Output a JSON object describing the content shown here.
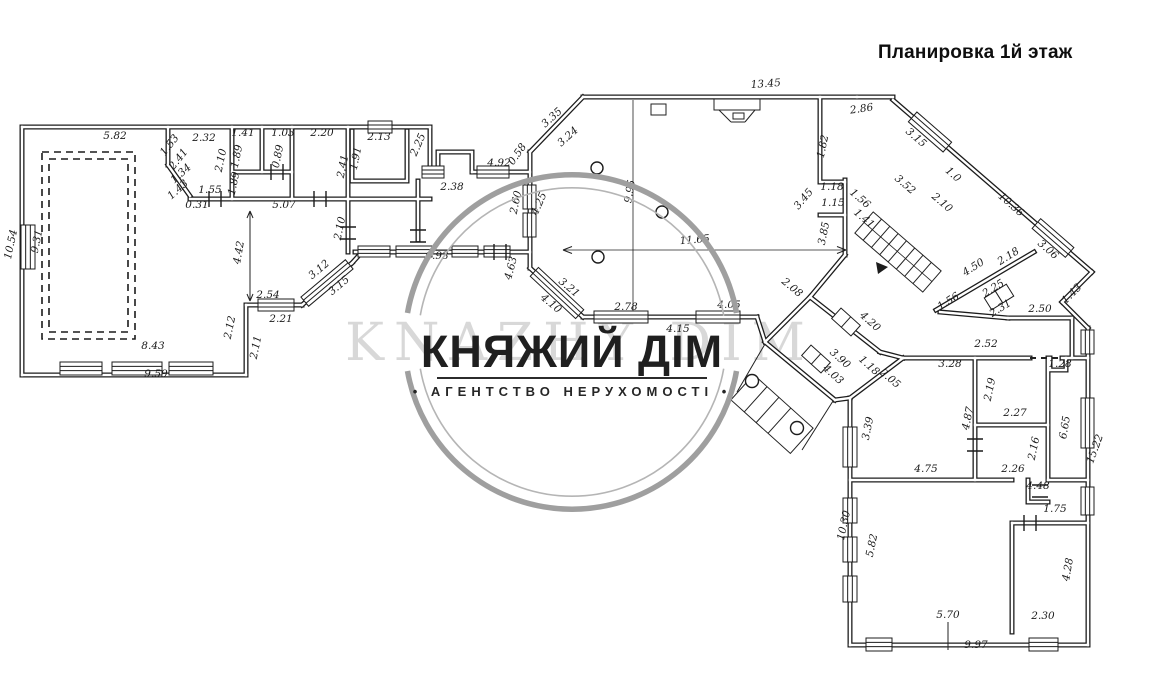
{
  "title": "Планировка 1й этаж",
  "watermark": {
    "brand": "КНЯЖИЙ ДІМ",
    "tagline": "• АГЕНТСТВО НЕРУХОМОСТІ •",
    "ghost": "KNAZHY DIM",
    "ring_color": "#9f9f9f",
    "text_color": "#1f1f1f"
  },
  "plan": {
    "ink_color": "#1c1c1c",
    "dimensions": [
      {
        "t": "5.82",
        "x": 115,
        "y": 139,
        "r": 0
      },
      {
        "t": "2.32",
        "x": 204,
        "y": 141,
        "r": 0
      },
      {
        "t": "1.53",
        "x": 172,
        "y": 147,
        "r": -52
      },
      {
        "t": "2.41",
        "x": 181,
        "y": 161,
        "r": -52
      },
      {
        "t": "2.10",
        "x": 224,
        "y": 161,
        "r": -78
      },
      {
        "t": "1.41",
        "x": 243,
        "y": 136,
        "r": 0
      },
      {
        "t": "1.89",
        "x": 240,
        "y": 157,
        "r": -78
      },
      {
        "t": "1.03",
        "x": 283,
        "y": 136,
        "r": 0
      },
      {
        "t": "0.89",
        "x": 281,
        "y": 157,
        "r": -78
      },
      {
        "t": "2.20",
        "x": 322,
        "y": 136,
        "r": 0
      },
      {
        "t": "1.89",
        "x": 237,
        "y": 184,
        "r": -78
      },
      {
        "t": "1.55",
        "x": 210,
        "y": 193,
        "r": 0
      },
      {
        "t": "1.34",
        "x": 183,
        "y": 176,
        "r": -42
      },
      {
        "t": "1.43",
        "x": 180,
        "y": 192,
        "r": -42
      },
      {
        "t": "0.31",
        "x": 197,
        "y": 208,
        "r": 0
      },
      {
        "t": "5.07",
        "x": 284,
        "y": 208,
        "r": 0
      },
      {
        "t": "2.13",
        "x": 379,
        "y": 140,
        "r": 0
      },
      {
        "t": "1.91",
        "x": 359,
        "y": 159,
        "r": -78
      },
      {
        "t": "2.41",
        "x": 346,
        "y": 167,
        "r": -78
      },
      {
        "t": "2.25",
        "x": 421,
        "y": 146,
        "r": -66
      },
      {
        "t": "2.10",
        "x": 343,
        "y": 229,
        "r": -78
      },
      {
        "t": "2.38",
        "x": 452,
        "y": 190,
        "r": 0
      },
      {
        "t": "4.92",
        "x": 499,
        "y": 166,
        "r": 0
      },
      {
        "t": "0.58",
        "x": 520,
        "y": 156,
        "r": -55
      },
      {
        "t": "2.60",
        "x": 519,
        "y": 203,
        "r": -78
      },
      {
        "t": "4.25",
        "x": 542,
        "y": 205,
        "r": -66
      },
      {
        "t": "13.45",
        "x": 766,
        "y": 87,
        "r": -4
      },
      {
        "t": "3.35",
        "x": 554,
        "y": 120,
        "r": -42
      },
      {
        "t": "3.24",
        "x": 570,
        "y": 139,
        "r": -42
      },
      {
        "t": "9.95",
        "x": 633,
        "y": 192,
        "r": -80
      },
      {
        "t": "11.65",
        "x": 695,
        "y": 243,
        "r": -5
      },
      {
        "t": "2.86",
        "x": 862,
        "y": 112,
        "r": -8
      },
      {
        "t": "1.82",
        "x": 826,
        "y": 147,
        "r": -78
      },
      {
        "t": "3.15",
        "x": 914,
        "y": 140,
        "r": 41
      },
      {
        "t": "3.52",
        "x": 903,
        "y": 187,
        "r": 41
      },
      {
        "t": "1.0",
        "x": 951,
        "y": 177,
        "r": 41
      },
      {
        "t": "2.10",
        "x": 940,
        "y": 205,
        "r": 41
      },
      {
        "t": "10.36",
        "x": 1009,
        "y": 207,
        "r": 41
      },
      {
        "t": "3.06",
        "x": 1046,
        "y": 252,
        "r": 41
      },
      {
        "t": "1.43",
        "x": 1074,
        "y": 296,
        "r": -45
      },
      {
        "t": "1.18",
        "x": 832,
        "y": 190,
        "r": 0
      },
      {
        "t": "1.15",
        "x": 833,
        "y": 206,
        "r": 0
      },
      {
        "t": "3.45",
        "x": 806,
        "y": 201,
        "r": -50
      },
      {
        "t": "3.85",
        "x": 827,
        "y": 234,
        "r": -78
      },
      {
        "t": "1.56",
        "x": 858,
        "y": 201,
        "r": 41
      },
      {
        "t": "1.41",
        "x": 862,
        "y": 221,
        "r": 41
      },
      {
        "t": "4.50",
        "x": 975,
        "y": 270,
        "r": -32
      },
      {
        "t": "2.18",
        "x": 1010,
        "y": 259,
        "r": -32
      },
      {
        "t": "1.56",
        "x": 950,
        "y": 304,
        "r": -32
      },
      {
        "t": "2.25",
        "x": 995,
        "y": 291,
        "r": -32
      },
      {
        "t": "2.31",
        "x": 1002,
        "y": 311,
        "r": -32
      },
      {
        "t": "2.50",
        "x": 1040,
        "y": 312,
        "r": 0
      },
      {
        "t": "4.42",
        "x": 242,
        "y": 253,
        "r": -80
      },
      {
        "t": "2.54",
        "x": 268,
        "y": 298,
        "r": 0
      },
      {
        "t": "2.21",
        "x": 281,
        "y": 322,
        "r": 0
      },
      {
        "t": "2.12",
        "x": 233,
        "y": 328,
        "r": -78
      },
      {
        "t": "2.11",
        "x": 259,
        "y": 348,
        "r": -78
      },
      {
        "t": "8.43",
        "x": 153,
        "y": 349,
        "r": 0
      },
      {
        "t": "9.59",
        "x": 156,
        "y": 377,
        "r": 0
      },
      {
        "t": "10.54",
        "x": 14,
        "y": 245,
        "r": -78
      },
      {
        "t": "9.31",
        "x": 40,
        "y": 242,
        "r": -78
      },
      {
        "t": "3.12",
        "x": 321,
        "y": 272,
        "r": -40
      },
      {
        "t": "3.15",
        "x": 341,
        "y": 288,
        "r": -40
      },
      {
        "t": "6.93",
        "x": 437,
        "y": 259,
        "r": 0
      },
      {
        "t": "4.63",
        "x": 514,
        "y": 269,
        "r": -75
      },
      {
        "t": "3.21",
        "x": 567,
        "y": 290,
        "r": 40
      },
      {
        "t": "4.10",
        "x": 549,
        "y": 306,
        "r": 40
      },
      {
        "t": "2.78",
        "x": 626,
        "y": 310,
        "r": 0
      },
      {
        "t": "4.05",
        "x": 729,
        "y": 308,
        "r": 0
      },
      {
        "t": "4.15",
        "x": 678,
        "y": 332,
        "r": 0
      },
      {
        "t": "2.08",
        "x": 790,
        "y": 290,
        "r": 40
      },
      {
        "t": "4.20",
        "x": 868,
        "y": 324,
        "r": 42
      },
      {
        "t": "3.90",
        "x": 838,
        "y": 361,
        "r": 42
      },
      {
        "t": "4.03",
        "x": 831,
        "y": 377,
        "r": 42
      },
      {
        "t": "1.18",
        "x": 867,
        "y": 368,
        "r": 42
      },
      {
        "t": "2.05",
        "x": 888,
        "y": 381,
        "r": 40
      },
      {
        "t": "2.52",
        "x": 986,
        "y": 347,
        "r": 0
      },
      {
        "t": "3.28",
        "x": 950,
        "y": 367,
        "r": 0
      },
      {
        "t": "1.28",
        "x": 1060,
        "y": 367,
        "r": 0
      },
      {
        "t": "2.19",
        "x": 993,
        "y": 390,
        "r": -78
      },
      {
        "t": "2.27",
        "x": 1015,
        "y": 416,
        "r": 0
      },
      {
        "t": "2.16",
        "x": 1037,
        "y": 449,
        "r": -78
      },
      {
        "t": "2.26",
        "x": 1013,
        "y": 472,
        "r": 0
      },
      {
        "t": "4.87",
        "x": 971,
        "y": 419,
        "r": -78
      },
      {
        "t": "4.75",
        "x": 926,
        "y": 472,
        "r": 0
      },
      {
        "t": "3.39",
        "x": 871,
        "y": 429,
        "r": -78
      },
      {
        "t": "6.65",
        "x": 1068,
        "y": 428,
        "r": -80
      },
      {
        "t": "15.22",
        "x": 1098,
        "y": 450,
        "r": -70
      },
      {
        "t": "4.48",
        "x": 1038,
        "y": 489,
        "r": 0
      },
      {
        "t": "1.75",
        "x": 1055,
        "y": 512,
        "r": 0
      },
      {
        "t": "10.30",
        "x": 847,
        "y": 526,
        "r": -78
      },
      {
        "t": "5.82",
        "x": 875,
        "y": 546,
        "r": -78
      },
      {
        "t": "5.70",
        "x": 948,
        "y": 618,
        "r": 0
      },
      {
        "t": "2.30",
        "x": 1043,
        "y": 619,
        "r": 0
      },
      {
        "t": "9.97",
        "x": 976,
        "y": 648,
        "r": 0
      },
      {
        "t": "4.28",
        "x": 1071,
        "y": 570,
        "r": -80
      }
    ]
  }
}
